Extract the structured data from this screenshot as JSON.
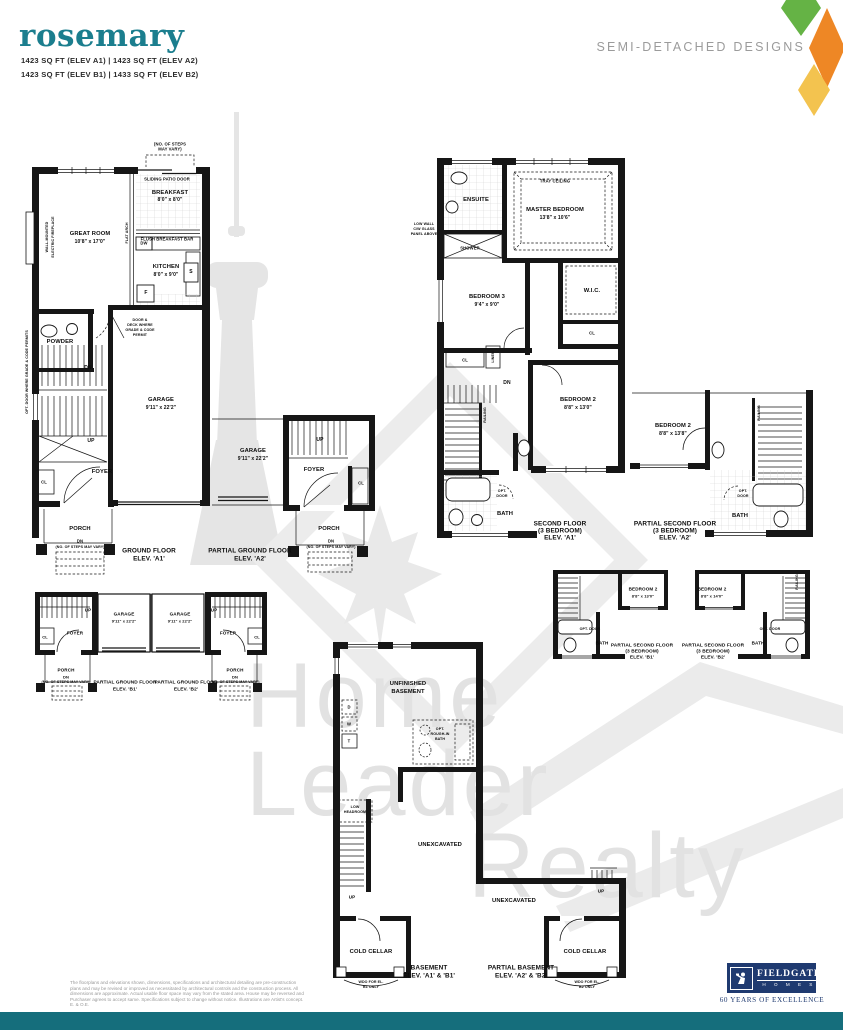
{
  "header": {
    "title": "rosemary",
    "sqft_line1": "1423 SQ FT (ELEV A1)  |  1423 SQ FT (ELEV A2)",
    "sqft_line2": "1423 SQ FT (ELEV B1)  |  1433 SQ FT (ELEV B2)",
    "category": "SEMI-DETACHED DESIGNS"
  },
  "watermark": {
    "word1": "Home",
    "word2": "Leader",
    "word3": "Realty"
  },
  "colors": {
    "teal_title": "#1b7e8e",
    "teal_bar": "#156e7c",
    "heading_gray": "#9b9b9b",
    "navy": "#1f3a70",
    "diamond_green": "#65b345",
    "diamond_orange": "#ee8725",
    "diamond_yellow": "#f3c34f",
    "watermark_gray": "#e2e2e2"
  },
  "plans": {
    "ground_a1": {
      "steps_note_1": "(NO. OF STEPS",
      "steps_note_2": "MAY VARY)",
      "sliding_door": "SLIDING PATIO DOOR",
      "breakfast": "BREAKFAST",
      "breakfast_dim": "8'0\" x 8'0\"",
      "flush_bar": "FLUSH BREAKFAST BAR",
      "dw": "DW",
      "great_room": "GREAT ROOM",
      "great_room_dim": "10'8\" x 17'0\"",
      "fireplace_1": "WALL-MOUNTED",
      "fireplace_2": "ELECTRIC FIREPLACE",
      "flat_arch": "FLAT ARCH",
      "kitchen": "KITCHEN",
      "kitchen_dim": "8'0\" x 9'0\"",
      "stove": "S",
      "fridge": "F",
      "deck_note_1": "DOOR &",
      "deck_note_2": "DECK WHERE",
      "deck_note_3": "GRADE & CODE",
      "deck_note_4": "PERMIT",
      "powder": "POWDER",
      "opt_door_note": "OPT. DOOR WHERE GRADE & CODE PERMITS",
      "dn": "DN",
      "garage": "GARAGE",
      "garage_dim": "9'11\" x 22'2\"",
      "up": "UP",
      "foyer": "FOYER",
      "cl": "CL",
      "porch": "PORCH",
      "porch_dn": "DN",
      "porch_steps_note": "(NO. OF STEPS MAY VARY)",
      "caption_1": "GROUND FLOOR",
      "caption_2": "ELEV. 'A1'"
    },
    "ground_a2": {
      "garage": "GARAGE",
      "garage_dim": "9'11\" x 22'2\"",
      "up": "UP",
      "foyer": "FOYER",
      "cl": "CL",
      "porch": "PORCH",
      "porch_dn": "DN",
      "porch_steps_note": "(NO. OF STEPS MAY VARY)",
      "caption_1": "PARTIAL GROUND FLOOR",
      "caption_2": "ELEV. 'A2'"
    },
    "second_a1": {
      "low_wall_1": "LOW WALL",
      "low_wall_2": "C/W GLASS",
      "low_wall_3": "PANEL ABOVE",
      "ensuite": "ENSUITE",
      "shower": "SHOWER",
      "tray_ceiling": "TRAY CEILING",
      "master": "MASTER BEDROOM",
      "master_dim": "13'8\" x 10'6\"",
      "bedroom3": "BEDROOM 3",
      "bedroom3_dim": "9'4\" x 9'0\"",
      "wic": "W.I.C.",
      "wic_cl": "CL",
      "hall_cl": "CL",
      "linen": "LINEN",
      "dn": "DN",
      "railing": "RAILING",
      "bedroom2": "BEDROOM 2",
      "bedroom2_dim": "8'8\" x 13'0\"",
      "opt_door_1": "OPT.",
      "opt_door_2": "DOOR",
      "bath": "BATH",
      "caption_1": "SECOND FLOOR",
      "caption_2": "(3 BEDROOM)",
      "caption_3": "ELEV. 'A1'"
    },
    "second_a2": {
      "bedroom2": "BEDROOM 2",
      "bedroom2_dim": "8'8\" x 13'8\"",
      "railing": "RAILING",
      "opt_door_1": "OPT.",
      "opt_door_2": "DOOR",
      "bath": "BATH",
      "caption_1": "PARTIAL SECOND FLOOR",
      "caption_2": "(3 BEDROOM)",
      "caption_3": "ELEV. 'A2'"
    },
    "ground_b1": {
      "up": "UP",
      "garage": "GARAGE",
      "garage_dim": "9'11\" x 22'2\"",
      "foyer": "FOYER",
      "cl": "CL",
      "porch": "PORCH",
      "porch_dn": "DN",
      "porch_steps_note": "(NO. OF STEPS MAY VARY)",
      "caption_1": "PARTIAL GROUND FLOOR",
      "caption_2": "ELEV. 'B1'"
    },
    "ground_b2": {
      "up": "UP",
      "garage": "GARAGE",
      "garage_dim": "9'11\" x 22'2\"",
      "foyer": "FOYER",
      "cl": "CL",
      "porch": "PORCH",
      "porch_dn": "DN",
      "porch_steps_note": "(NO. OF STEPS MAY VARY)",
      "caption_1": "PARTIAL GROUND FLOOR",
      "caption_2": "ELEV. 'B2'"
    },
    "second_b1": {
      "bedroom2": "BEDROOM 2",
      "bedroom2_dim": "8'8\" x 13'0\"",
      "opt_door": "OPT. DOOR",
      "bath": "BATH",
      "caption_1": "PARTIAL SECOND FLOOR",
      "caption_2": "(3 BEDROOM)",
      "caption_3": "ELEV. 'B1'"
    },
    "second_b2": {
      "bedroom2": "BEDROOM 2",
      "bedroom2_dim": "8'8\" x 14'0\"",
      "railing": "RAILING",
      "opt_door": "OPT. DOOR",
      "bath": "BATH",
      "caption_1": "PARTIAL SECOND FLOOR",
      "caption_2": "(3 BEDROOM)",
      "caption_3": "ELEV. 'B2'"
    },
    "basement": {
      "unfinished_1": "UNFINISHED",
      "unfinished_2": "BASEMENT",
      "dryer": "D",
      "washer": "W",
      "tank": "T",
      "rough_in_1": "OPT.",
      "rough_in_2": "ROUGH-IN",
      "rough_in_3": "BATH",
      "low_headroom_1": "LOW",
      "low_headroom_2": "HEADROOM",
      "unexcavated_1": "UNEXCAVATED",
      "unexcavated_2": "UNEXCAVATED",
      "up_left": "UP",
      "up_right": "UP",
      "cold_cellar_left": "COLD CELLAR",
      "cold_cellar_right": "COLD CELLAR",
      "wdo_left_1": "WDO FOR EL.",
      "wdo_left_2": "B1 ONLY",
      "wdo_right_1": "WDO FOR EL.",
      "wdo_right_2": "B2 ONLY",
      "caption_left_1": "BASEMENT",
      "caption_left_2": "ELEV. 'A1' & 'B1'",
      "caption_right_1": "PARTIAL BASEMENT",
      "caption_right_2": "ELEV. 'A2' & 'B2'"
    }
  },
  "footer": {
    "disclaimer": "The floorplans and elevations shown, dimensions, specifications and architectural detailing are pre-construction plans and may be revised or improved as necessitated by architectural controls and the construction process. All dimensions are approximate. Actual usable floor space may vary from the stated area. House may be reversed and Purchaser agrees to accept same. Specifications subject to change without notice. Illustrations are Artist's concept. E. & O.E.",
    "brand": "FIELDGATE",
    "brand_sub": "H O M E S",
    "brand_tagline": "60 YEARS OF EXCELLENCE"
  }
}
